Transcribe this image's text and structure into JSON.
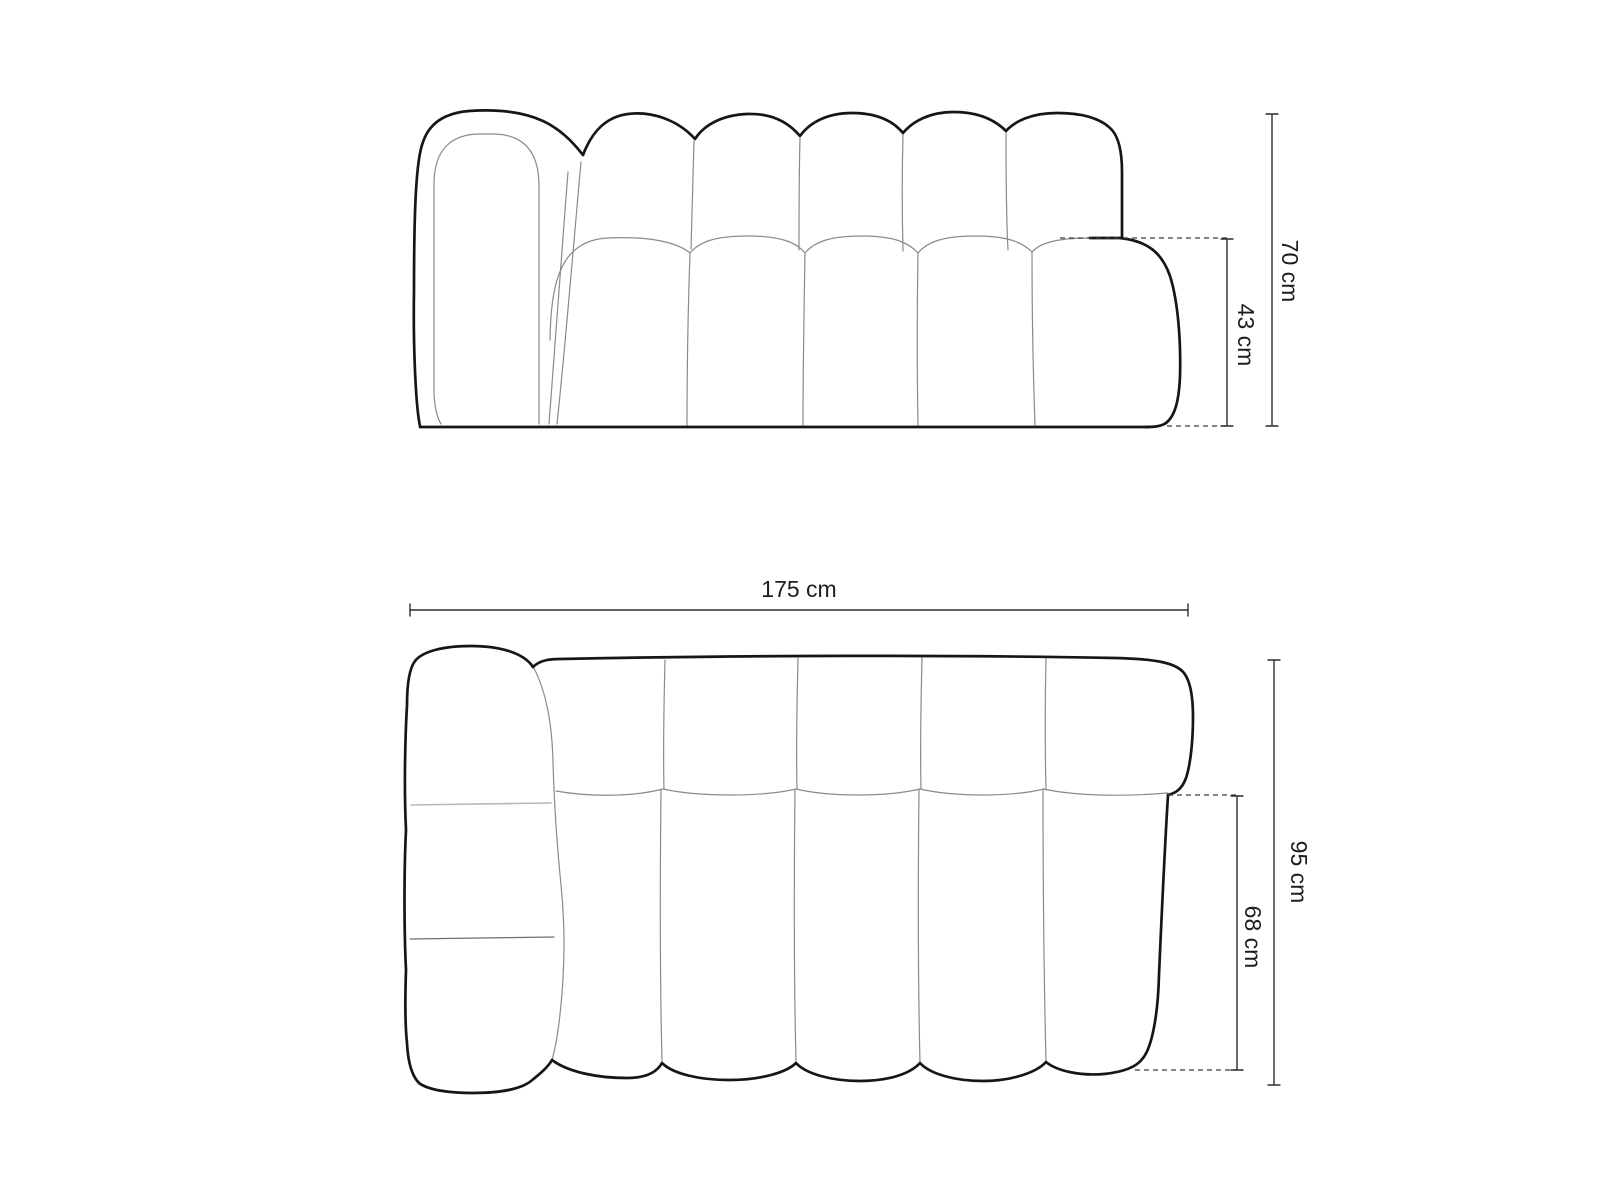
{
  "diagram": {
    "type": "sofa-dimension-drawing",
    "front_view": {
      "height_label": "70 cm",
      "seat_height_label": "43 cm"
    },
    "top_view": {
      "width_label": "175 cm",
      "depth_label": "95 cm",
      "seat_depth_label": "68 cm"
    }
  },
  "colors": {
    "background": "#ffffff",
    "outline": "#161616",
    "thin_line": "#8a8a8a",
    "dimension_line": "#2d2d2d",
    "label_text": "#1d1d1d"
  }
}
